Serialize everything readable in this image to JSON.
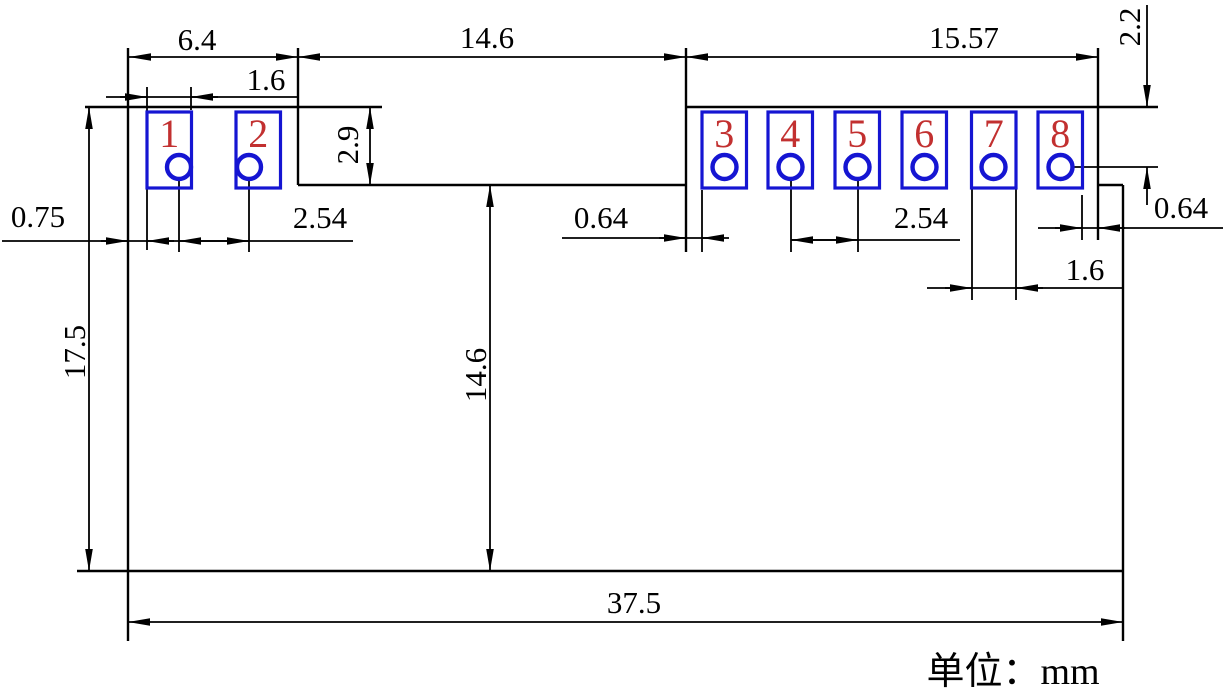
{
  "unit_note": "单位：mm",
  "colors": {
    "line": "#000000",
    "pad_outline": "#1515d2",
    "pin_number": "#c23030",
    "background": "#ffffff"
  },
  "pins": [
    {
      "number": "1",
      "x": 147,
      "hole_cx": 179
    },
    {
      "number": "2",
      "x": 236,
      "hole_cx": 249
    },
    {
      "number": "3",
      "x": 702,
      "hole_cx": 724.5
    },
    {
      "number": "4",
      "x": 768,
      "hole_cx": 790.5
    },
    {
      "number": "5",
      "x": 835,
      "hole_cx": 857.5
    },
    {
      "number": "6",
      "x": 902,
      "hole_cx": 924.5
    },
    {
      "number": "7",
      "x": 971.5,
      "hole_cx": 993.5
    },
    {
      "number": "8",
      "x": 1038,
      "hole_cx": 1060.5
    }
  ],
  "pad_geometry": {
    "top_y": 112,
    "width": 44.5,
    "height": 76,
    "hole_cy": 167,
    "hole_r": 12
  },
  "dims": {
    "left_section_width": "6.4",
    "middle_section_width": "14.6",
    "right_section_width": "15.57",
    "top_to_pin_right": "2.2",
    "pad_width_left": "1.6",
    "left_step_height": "2.9",
    "edge_to_pad_gap": "0.75",
    "pin_pitch_left": "2.54",
    "step_to_pad_gap_mid": "0.64",
    "pin_pitch_right": "2.54",
    "pad_to_notch_gap_right": "0.64",
    "pad_width_right": "1.6",
    "body_height": "17.5",
    "middle_section_height": "14.6",
    "body_width": "37.5"
  }
}
